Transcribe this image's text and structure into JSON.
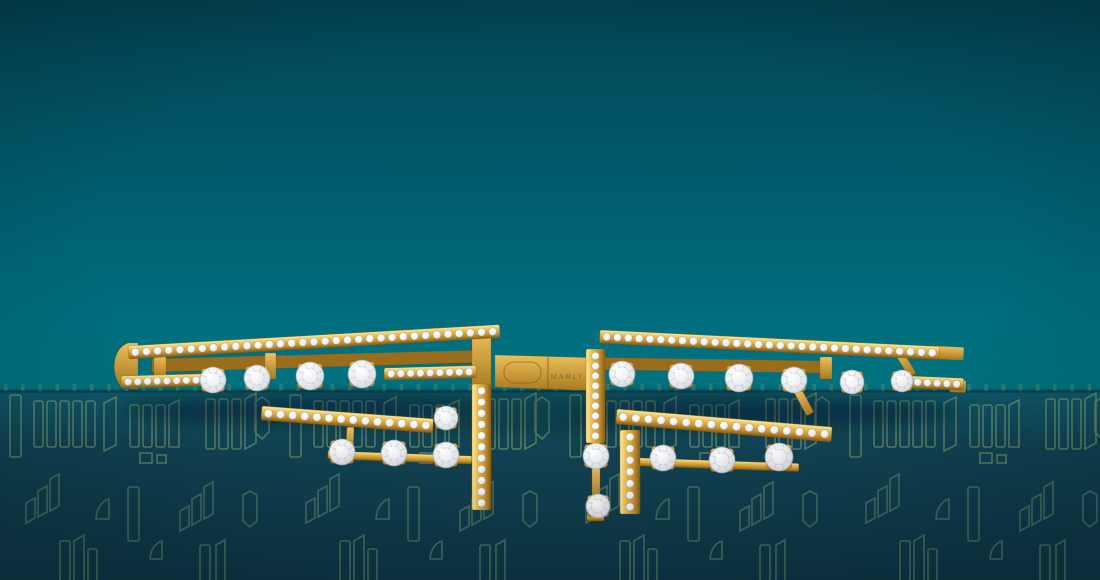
{
  "scene": {
    "description": "Top view of an open yellow-gold cuff bracelet set with pave and prong-set round diamonds, resting on a dark teal pedestal decorated with an outlined city-skyline / monogram pattern, against a teal gradient backdrop.",
    "engraving": {
      "text": "MARLI"
    }
  },
  "palette": {
    "bg_top": "#03404e",
    "bg_upper": "#02495a",
    "bg_mid": "#015b6c",
    "bg_lower": "#006e7e",
    "bg_bottom": "#00737f",
    "table_edge": "#0e5868",
    "table_mid": "#114353",
    "table_bottom": "#0e3746",
    "edge_seam": "#05222e",
    "pattern_stroke": "#6e9470",
    "pattern_stroke_bright": "#7fa072",
    "gold_light": "#ffe9a0",
    "gold_mid": "#e9b83f",
    "gold_deep": "#c8922a",
    "gold_shadow": "#8a5c14",
    "gold_flat_hi": "#eec05a",
    "gold_flat_lo": "#a87a1e",
    "gold_dark": "#9a6d1c",
    "diamond_core": "#ffffff",
    "diamond_mid": "#edeff2",
    "diamond_edge": "#b6bcc6",
    "diamond_rim": "#9aa0ab",
    "engraving_color": "#7c5c1e",
    "shadow_color": "#021018"
  },
  "backdrop": {
    "edge_y": 391,
    "ticks": {
      "count": 64,
      "y": 384,
      "width": 3.5,
      "height": 7,
      "step": 17.2,
      "opacity": 0.32
    },
    "shadows": [
      {
        "cx": 545,
        "cy": 412,
        "rx": 425,
        "ry": 21,
        "opacity": 0.2
      },
      {
        "cx": 300,
        "cy": 408,
        "rx": 175,
        "ry": 12,
        "opacity": 0.26
      },
      {
        "cx": 760,
        "cy": 412,
        "rx": 190,
        "ry": 13,
        "opacity": 0.26
      }
    ]
  },
  "bracelet": {
    "plain_parts": [
      {
        "type": "path",
        "d": "M128,343 C112,349 110,374 122,388 L138,389 L138,343 Z",
        "fill": "flat"
      },
      {
        "type": "path",
        "d": "M152,359 L488,350 L488,362 L152,372 Z",
        "fill": "dark"
      },
      {
        "type": "rect",
        "x": 154,
        "y": 355,
        "w": 12,
        "h": 25,
        "fill": "flat"
      },
      {
        "type": "rect",
        "x": 265,
        "y": 353,
        "w": 11,
        "h": 26,
        "fill": "flat"
      },
      {
        "type": "path",
        "d": "M560,357 L828,361 L828,373 L560,369 Z",
        "fill": "dark"
      },
      {
        "type": "rect",
        "x": 820,
        "y": 357,
        "w": 12,
        "h": 22,
        "fill": "flat"
      },
      {
        "type": "rect",
        "x": 893,
        "y": 351,
        "w": 8,
        "h": 31,
        "angle": -32,
        "fill": "flat"
      },
      {
        "type": "rect",
        "x": 794,
        "y": 392,
        "w": 8,
        "h": 27,
        "angle": -28,
        "fill": "flat"
      },
      {
        "type": "path",
        "d": "M495,355 L601,358 L601,391 L495,387 Z",
        "fill": "flat"
      },
      {
        "type": "rect",
        "x": 347,
        "y": 427,
        "w": 7,
        "h": 27,
        "angle": 3,
        "fill": "flat"
      },
      {
        "type": "rect",
        "x": 328,
        "y": 451,
        "w": 144,
        "h": 8,
        "angle": 2,
        "fill": "bar"
      },
      {
        "type": "rect",
        "x": 639,
        "y": 458,
        "w": 160,
        "h": 8,
        "angle": 2,
        "fill": "bar"
      },
      {
        "type": "rect",
        "x": 592,
        "y": 467,
        "w": 8,
        "h": 33,
        "fill": "flat"
      },
      {
        "type": "rect",
        "x": 587,
        "y": 513,
        "w": 17,
        "h": 8,
        "fill": "bar"
      },
      {
        "type": "rect",
        "x": 472,
        "y": 330,
        "w": 19,
        "h": 60,
        "fill": "flat"
      },
      {
        "type": "rect",
        "x": 936,
        "y": 346,
        "w": 28,
        "h": 13,
        "angle": 2.8,
        "fill": "flat"
      },
      {
        "type": "rect",
        "x": 950,
        "y": 380,
        "w": 16,
        "h": 12,
        "angle": 2.5,
        "fill": "flat"
      }
    ],
    "pave_bars": [
      {
        "x": 128,
        "y": 346,
        "w": 372,
        "h": 13,
        "angle": -3.3,
        "dots": 33,
        "dotR": 4.0,
        "axis": "h"
      },
      {
        "x": 121,
        "y": 376,
        "w": 82,
        "h": 12,
        "angle": -1.5,
        "dots": 8,
        "dotR": 3.8,
        "axis": "h"
      },
      {
        "x": 384,
        "y": 368,
        "w": 92,
        "h": 12,
        "angle": -1.5,
        "dots": 9,
        "dotR": 3.8,
        "axis": "h"
      },
      {
        "x": 262,
        "y": 406,
        "w": 172,
        "h": 14,
        "angle": 4.3,
        "dots": 14,
        "dotR": 4.2,
        "axis": "h"
      },
      {
        "x": 472,
        "y": 384,
        "w": 19,
        "h": 126,
        "angle": 0,
        "dots": 11,
        "dotR": 4.0,
        "axis": "v"
      },
      {
        "x": 600,
        "y": 330,
        "w": 340,
        "h": 13,
        "angle": 2.8,
        "dots": 31,
        "dotR": 4.0,
        "axis": "h"
      },
      {
        "x": 911,
        "y": 376,
        "w": 53,
        "h": 12,
        "angle": 2.5,
        "dots": 5,
        "dotR": 3.8,
        "axis": "h"
      },
      {
        "x": 586,
        "y": 349,
        "w": 19,
        "h": 94,
        "angle": 0,
        "dots": 9,
        "dotR": 3.8,
        "axis": "v"
      },
      {
        "x": 617,
        "y": 409,
        "w": 216,
        "h": 15,
        "angle": 4.8,
        "dots": 17,
        "dotR": 4.2,
        "axis": "h"
      },
      {
        "x": 620,
        "y": 430,
        "w": 20,
        "h": 84,
        "angle": 0,
        "dots": 7,
        "dotR": 4.0,
        "axis": "v"
      }
    ],
    "stones": [
      {
        "cx": 213,
        "cy": 380,
        "r": 13
      },
      {
        "cx": 257,
        "cy": 378,
        "r": 13
      },
      {
        "cx": 310,
        "cy": 376,
        "r": 14
      },
      {
        "cx": 362,
        "cy": 374,
        "r": 14
      },
      {
        "cx": 446,
        "cy": 418,
        "r": 12
      },
      {
        "cx": 342,
        "cy": 452,
        "r": 13
      },
      {
        "cx": 394,
        "cy": 453,
        "r": 13
      },
      {
        "cx": 446,
        "cy": 455,
        "r": 13
      },
      {
        "cx": 622,
        "cy": 374,
        "r": 13
      },
      {
        "cx": 681,
        "cy": 376,
        "r": 13
      },
      {
        "cx": 739,
        "cy": 378,
        "r": 14
      },
      {
        "cx": 794,
        "cy": 380,
        "r": 13
      },
      {
        "cx": 852,
        "cy": 382,
        "r": 12
      },
      {
        "cx": 902,
        "cy": 381,
        "r": 11
      },
      {
        "cx": 596,
        "cy": 456,
        "r": 13
      },
      {
        "cx": 598,
        "cy": 506,
        "r": 12
      },
      {
        "cx": 663,
        "cy": 458,
        "r": 13
      },
      {
        "cx": 722,
        "cy": 460,
        "r": 13
      },
      {
        "cx": 779,
        "cy": 457,
        "r": 14
      }
    ]
  }
}
